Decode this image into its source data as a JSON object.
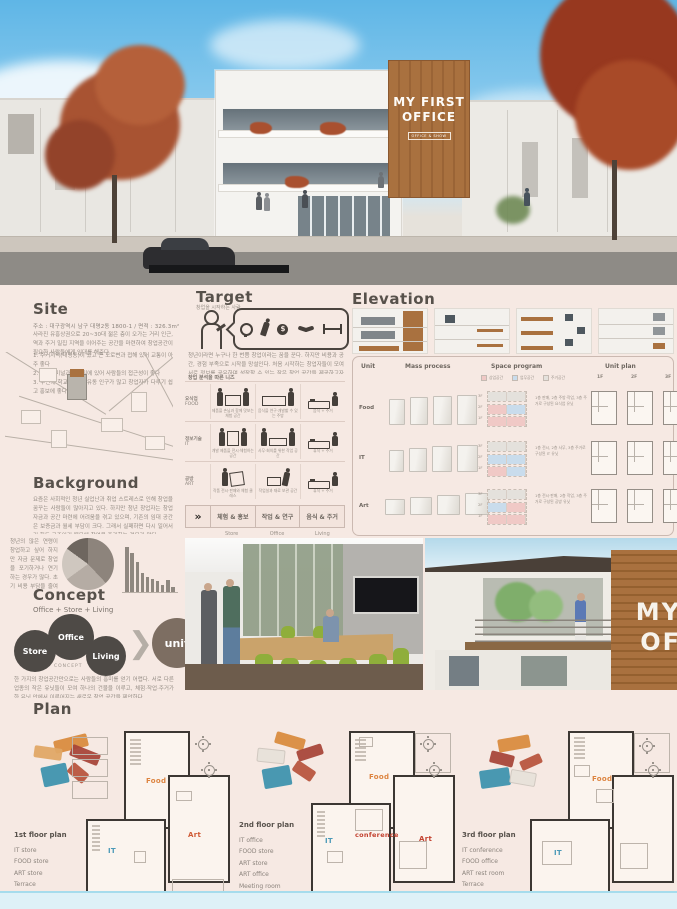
{
  "poster": {
    "bg": "#f6e9e3",
    "footer_bg": "#def1f7",
    "wood": "#a9713f"
  },
  "hero": {
    "sign_line1": "MY FIRST",
    "sign_line2": "OFFICE",
    "sign_sub": "OFFICE & SHOW"
  },
  "photos": {
    "exterior_sign_line1": "MY",
    "exterior_sign_line2": "OF"
  },
  "site": {
    "title": "Site",
    "address": "주소 :  대구광역시 남구 대명2동 1800-1   /   면적 :  326.3m²",
    "intro": "사라진 유흥상권으로 20~30대 젊은 층이 오가는 거리 인근, 역과 주거 밀집 지역을 이어주는 공간을 마련하여 창업공간이 필요한 사람들에게 임대를 해준다.",
    "points": [
      "1. 주거지역(대명동)이 있고 큰 도로변과 접해 있어 교통이 아주 좋다",
      "2. 버스터미널과 근거리에 있어 사람들의 접근성이 좋다",
      "3. 주변에 학교가 많아 유동 인구가 많고 창업자가 다루기 쉽고 홍보에 좋다"
    ]
  },
  "target": {
    "title": "Target",
    "subtitle": "창업을 시작하는 사람",
    "bubble_icons": [
      "lightbulb",
      "runner",
      "coin",
      "handshake",
      "barbell"
    ],
    "description": "청년이라면 누구나 한 번쯤 창업이라는 꿈을 꾼다. 하지만 비용과 공간, 경험 부족으로 시작을 망설인다. 처음 시작하는 창업자들이 모여 서로 정보를 공유하며 성장할 수 있는 작은 창업 공간을 제공하고자 한다.",
    "needs": {
      "caption": "창업 분석을 따른 니즈",
      "rows": [
        {
          "ko": "요식업",
          "en": "FOOD",
          "cells": [
            "제품을 손님과 함께 맛보는 체험 공간",
            "음식을 연구·개발할 수 있는 주방",
            "음식 + 주거"
          ]
        },
        {
          "ko": "정보기술",
          "en": "IT",
          "cells": [
            "개발 제품을 전시·체험하는 공간",
            "사무·회의를 위한 작업 공간",
            "휴식 + 주거"
          ]
        },
        {
          "ko": "공방",
          "en": "ART",
          "cells": [
            "작품 전시·판매와 체험 클래스",
            "작업실과 재료 보관 공간",
            "휴식 + 주거"
          ]
        }
      ],
      "summary": [
        "체험 & 홍보",
        "작업 & 연구",
        "음식 & 주거"
      ],
      "summary_en": [
        "Store",
        "Office",
        "Living"
      ]
    }
  },
  "elevation": {
    "title": "Elevation"
  },
  "unit_table": {
    "headers": [
      "Unit",
      "Mass process",
      "Space program",
      "Unit plan"
    ],
    "legend": [
      {
        "label": "상업공간",
        "color": "#f0c9c6"
      },
      {
        "label": "업무공간",
        "color": "#c9dcec"
      },
      {
        "label": "주거공간",
        "color": "#e4e1dc"
      }
    ],
    "floors": [
      "1F",
      "2F",
      "3F"
    ],
    "floors_desc": [
      "3F",
      "2F",
      "1F"
    ],
    "rows": [
      {
        "unit": "Food",
        "note": "1층 판매, 2층 주방·작업, 3층 주거로 구성된 요식업 유닛"
      },
      {
        "unit": "IT",
        "note": "1층 전시, 2층 사무, 3층 주거로 구성된 IT 유닛"
      },
      {
        "unit": "Art",
        "note": "1층 전시·판매, 2층 작업, 3층 주거로 구성된 공방 유닛"
      }
    ]
  },
  "background": {
    "title": "Background",
    "para1": "요즘은 사회적인 청년 실업난과 취업 스트레스로 인해 창업을 꿈꾸는 사람들이 많아지고 있다. 하지만 청년 창업자는 창업자금과 공간 마련에 어려움을 겪고 있으며, 기존의 임대 공간은 보증금과 월세 부담이 크다. 그래서 실패하면 다시 일어서기 힘든 구조이기 때문에 창업을 포기하는 경우가 많다.",
    "para2": "청년의 많은 연령이 창업하고 싶어 하지만 자금 문제로 창업을 포기하거나 연기하는 경우가 많다. 초기 비용 부담을 줄여 쉽게 시작할 수 있는 창업 공간이 필요하다.",
    "chart": {
      "pie": [
        38,
        27,
        20,
        15
      ],
      "bars": [
        90,
        78,
        60,
        38,
        30,
        26,
        22,
        14,
        24,
        10
      ]
    }
  },
  "concept": {
    "title": "Concept",
    "formula": "Office + Store + Living",
    "circles": [
      "Store",
      "Office",
      "Living"
    ],
    "caption": "CONCEPT",
    "unit_label": "unit",
    "description": "한 가지의 창업공간만으로는 사람들의 흥미를 얻기 어렵다. 서로 다른 업종의 작은 유닛들이 모여 하나의 건물을 이루고, 체험·작업·주거가 한 유닛 안에서 이루어지는 새로운 창업 공간을 제안한다."
  },
  "plan": {
    "title": "Plan",
    "groups": [
      {
        "name": "1st floor plan",
        "items": [
          "IT store",
          "FOOD store",
          "ART store",
          "Terrace"
        ],
        "rooms": [
          {
            "t": "Food",
            "c": "#dd8440"
          },
          {
            "t": "IT",
            "c": "#4b9ab8"
          },
          {
            "t": "Art",
            "c": "#cf5a35"
          }
        ]
      },
      {
        "name": "2nd floor plan",
        "items": [
          "IT office",
          "FOOD store",
          "ART store",
          "ART office",
          "Meeting room",
          "Terrace"
        ],
        "rooms": [
          {
            "t": "Food",
            "c": "#dd8440"
          },
          {
            "t": "conference",
            "c": "#c2402e"
          },
          {
            "t": "IT",
            "c": "#4b9ab8"
          },
          {
            "t": "Art",
            "c": "#c2402e"
          }
        ]
      },
      {
        "name": "3rd floor plan",
        "items": [
          "IT conference",
          "FOOD office",
          "ART rest room",
          "Terrace"
        ],
        "rooms": [
          {
            "t": "Food",
            "c": "#dd8440"
          },
          {
            "t": "IT",
            "c": "#4b9ab8"
          }
        ]
      }
    ]
  }
}
